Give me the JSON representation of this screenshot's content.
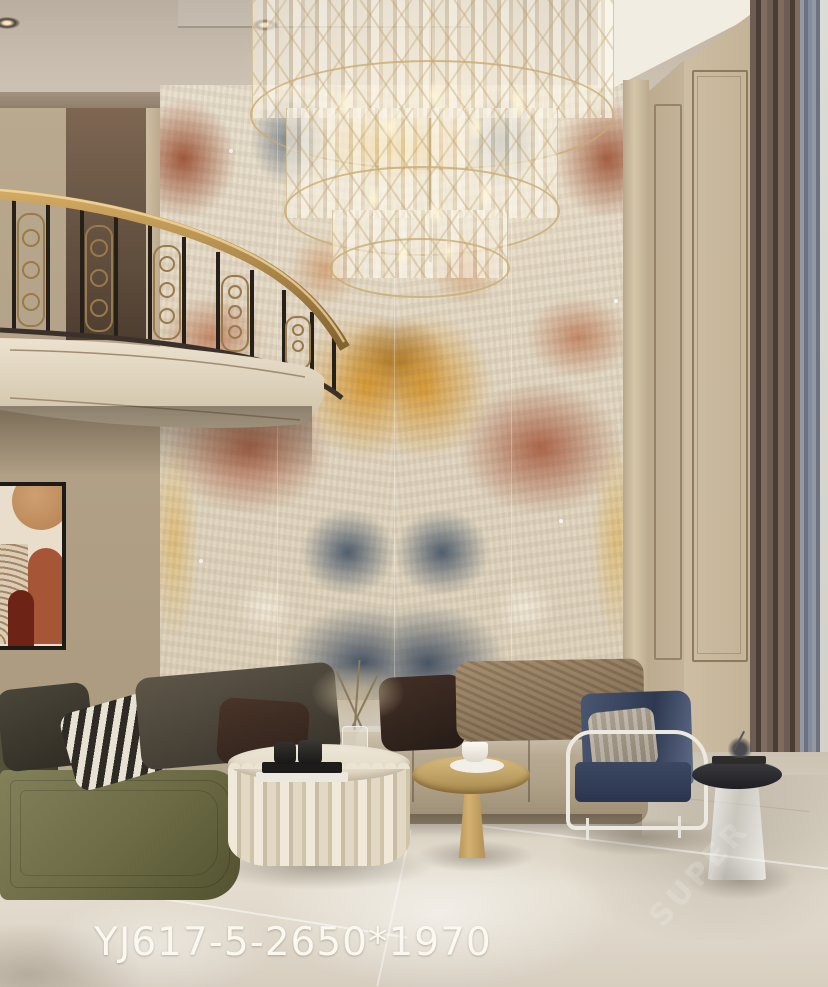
{
  "label": {
    "model_code": "YJ617-5-2650*1970"
  },
  "watermark": {
    "text": "SUPER"
  },
  "palette": {
    "marble_rust": "#9a4a2c",
    "marble_gold": "#d99a33",
    "marble_blue": "#4d5e72",
    "marble_cream": "#e9e0cf",
    "wall_beige": "#c3b296",
    "ceiling": "#c6bbab",
    "floor": "#d9d1c2",
    "curtain_brown": "#5d5048",
    "curtain_blue_gray": "#8a8f9c",
    "sofa_beige": "#b0a189",
    "chaise_olive": "#6b6a45",
    "armchair_navy": "#35405c",
    "railing_brass": "#b08a4a",
    "chair_frame_white": "#ece9e1",
    "label_text_color": "#faf8f0"
  }
}
